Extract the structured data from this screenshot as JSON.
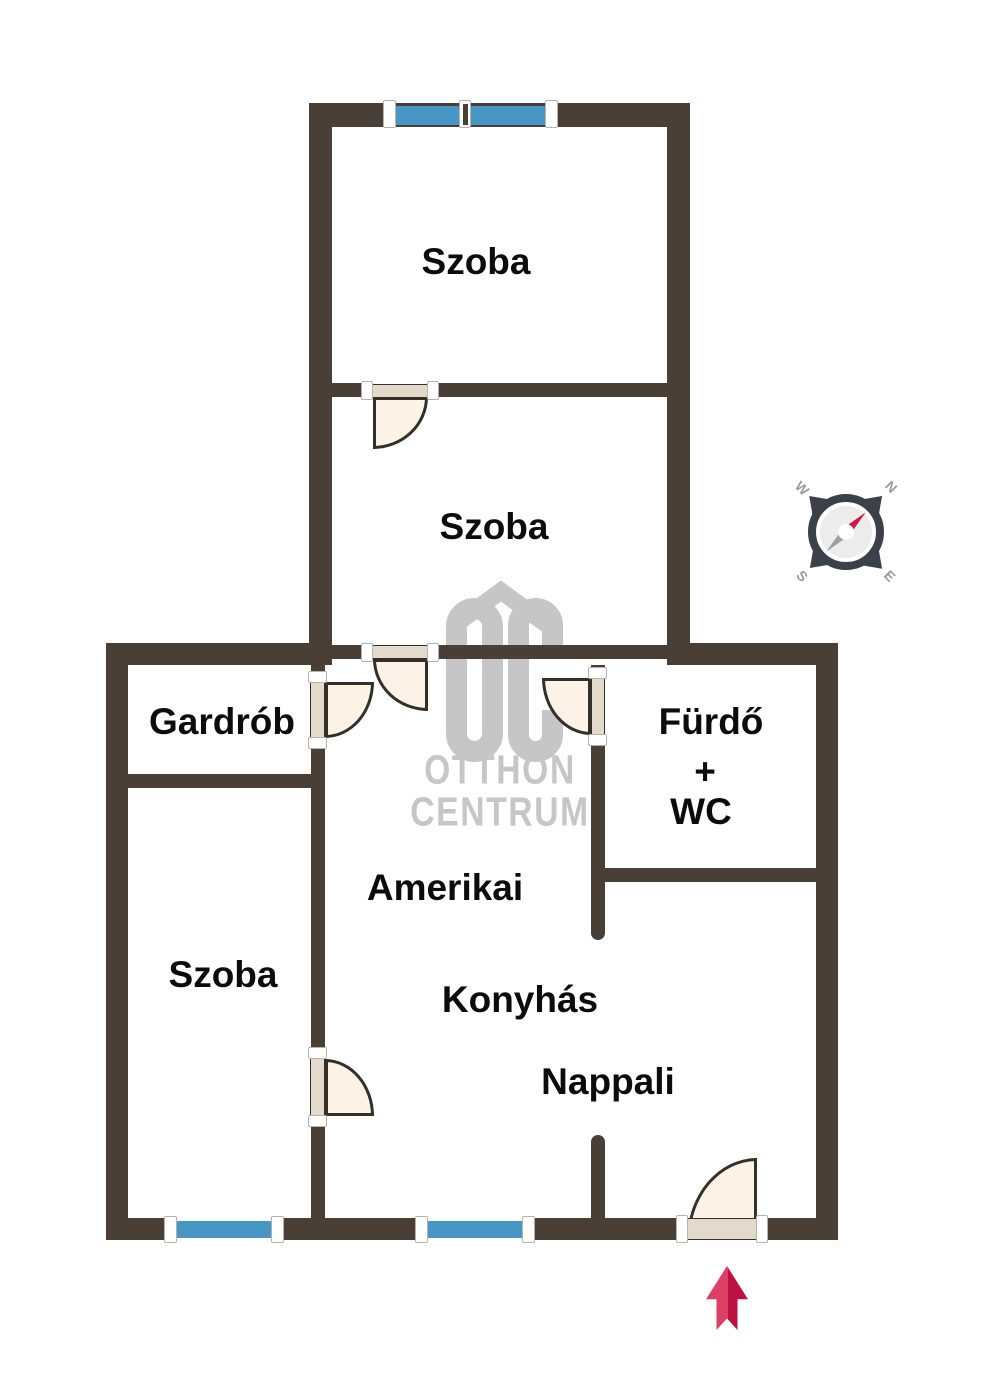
{
  "rooms": {
    "szoba_top": {
      "label": "Szoba"
    },
    "szoba_middle": {
      "label": "Szoba"
    },
    "gardrob": {
      "label": "Gardrób"
    },
    "bathroom": {
      "line1": "Fürdő",
      "line2": "+",
      "line3": "WC"
    },
    "szoba_left": {
      "label": "Szoba"
    },
    "living": {
      "line1": "Amerikai",
      "line2": "Konyhás",
      "line3": "Nappali"
    }
  },
  "watermark": {
    "brand_initials": "OC",
    "line1": "OTTHON",
    "line2": "CENTRUM"
  },
  "compass": {
    "north": "N",
    "south": "S",
    "east": "E",
    "west": "W"
  },
  "colors": {
    "wall": "#4a3f37",
    "window": "#4896c6",
    "door_fill": "#fcf3e6",
    "door_leaf": "#e3dacb",
    "door_outline": "#332f29",
    "label": "#0c0c0c",
    "watermark": "#c6c6c6",
    "compass_dark": "#3b4049",
    "needle_red": "#d01945",
    "needle_gray": "#9aa0a3",
    "arrow_light": "#dd4066",
    "arrow_dark": "#bb1243"
  }
}
